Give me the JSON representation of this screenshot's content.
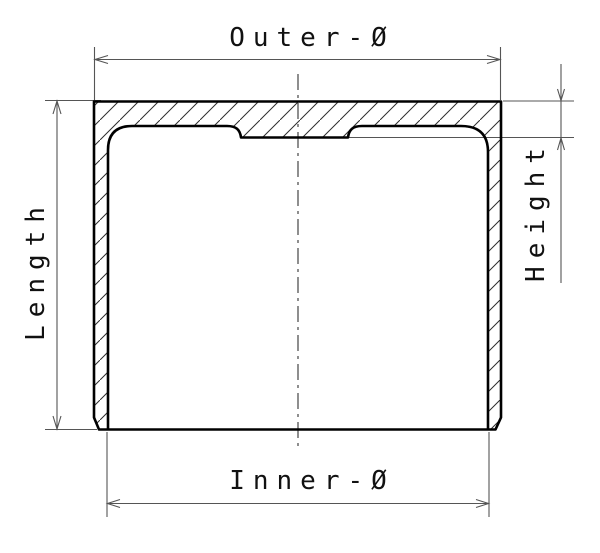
{
  "drawing": {
    "type": "technical-cross-section",
    "subject": "valve tappet / bucket cross-section with dimension callouts",
    "labels": {
      "outer_diameter": "Outer-Ø",
      "inner_diameter": "Inner-Ø",
      "length": "Length",
      "height": "Height"
    },
    "dimensions_annotated": [
      {
        "name": "Outer-Ø",
        "orientation": "horizontal",
        "position": "top",
        "measures": "outer diameter across top face"
      },
      {
        "name": "Inner-Ø",
        "orientation": "horizontal",
        "position": "bottom",
        "measures": "inner diameter between inside walls"
      },
      {
        "name": "Length",
        "orientation": "vertical",
        "position": "left",
        "measures": "overall length from top face to bottom rim"
      },
      {
        "name": "Height",
        "orientation": "vertical",
        "position": "right",
        "measures": "crown thickness from top face to inner boss face"
      }
    ],
    "style": {
      "background_color": "#ffffff",
      "outline_color": "#000000",
      "hatch_color": "#2e2e2e",
      "dimension_line_color": "#555555",
      "centerline_color": "#333333",
      "text_color": "#111111",
      "hatch_pattern": "45deg-diagonal",
      "centerline_style": "dash-dot"
    }
  }
}
